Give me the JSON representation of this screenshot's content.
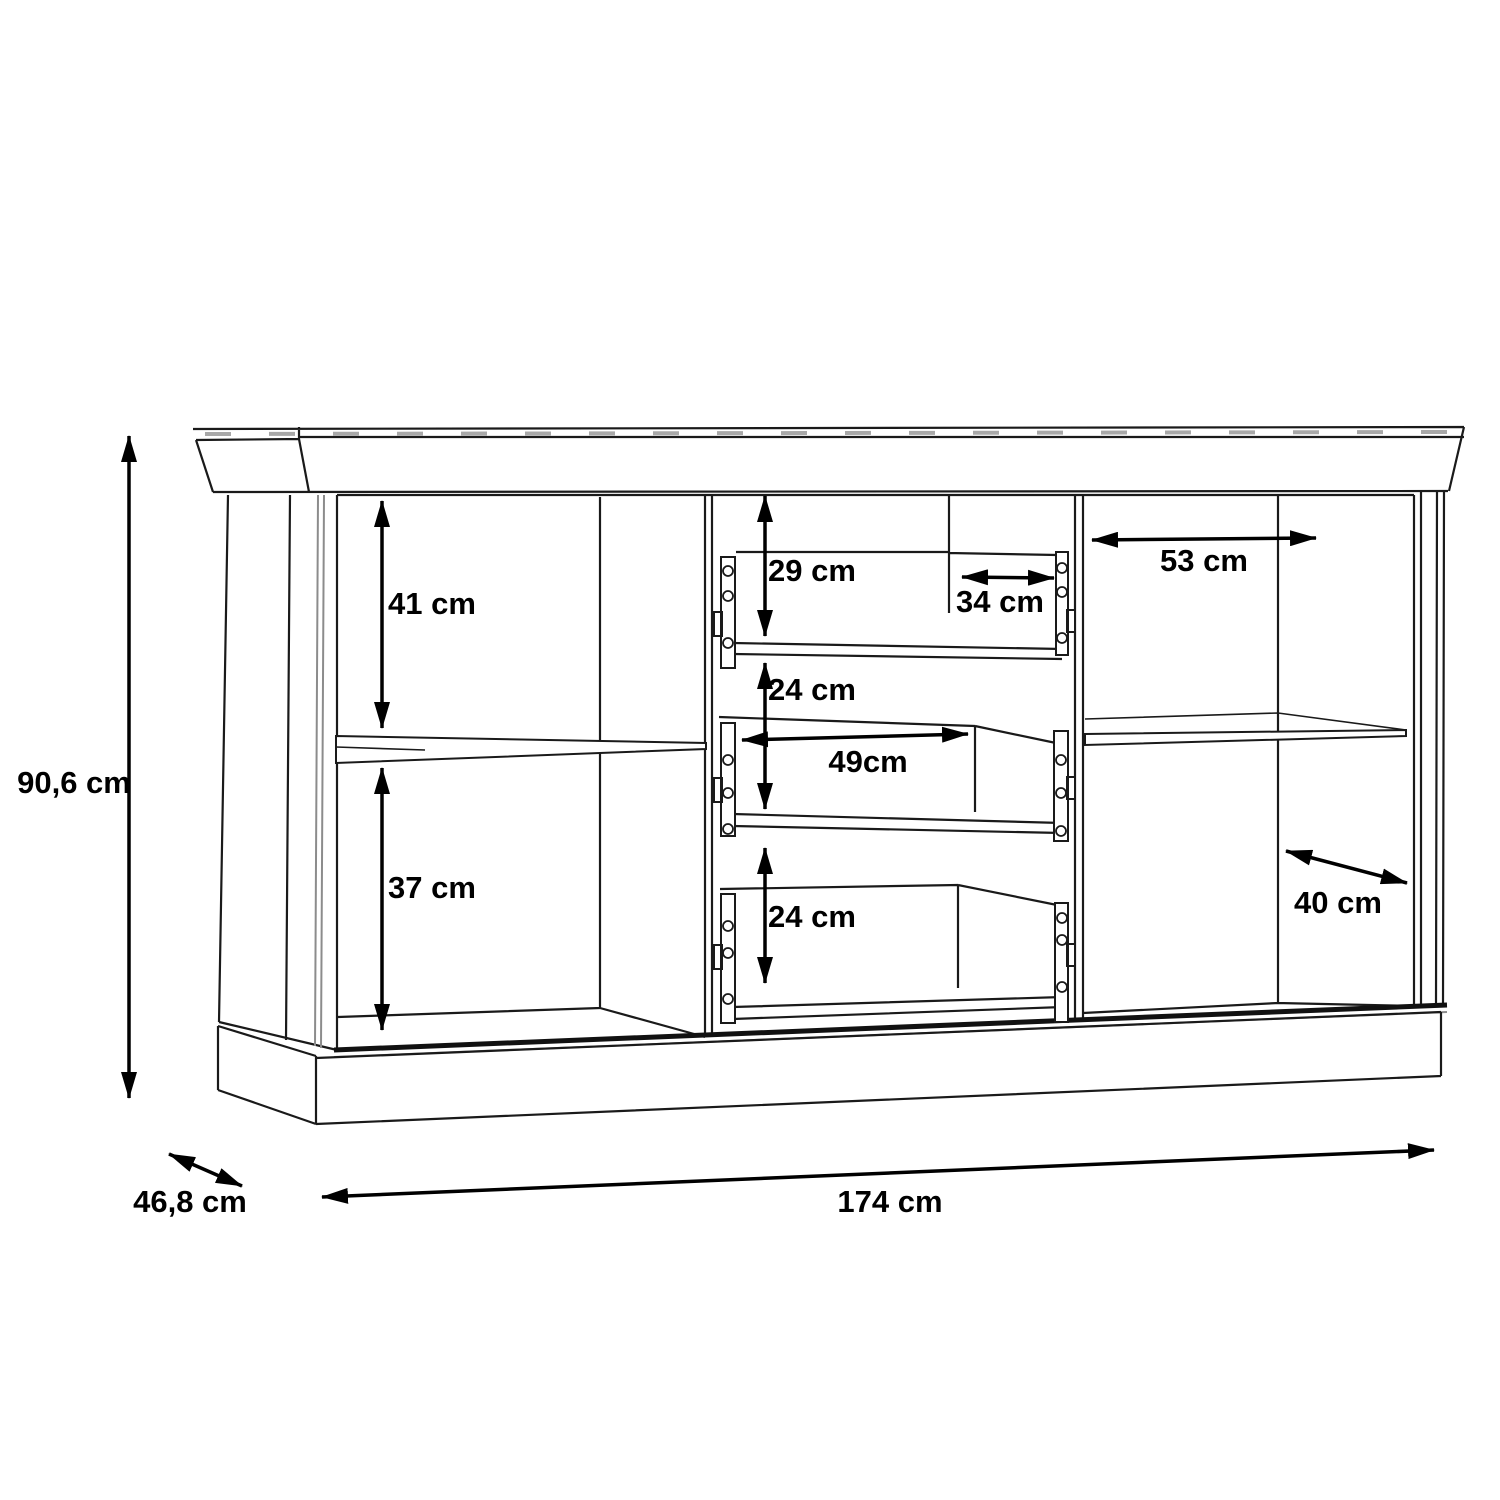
{
  "labels": {
    "height": "90,6 cm",
    "width": "174 cm",
    "depth": "46,8 cm",
    "left_upper_height": "41 cm",
    "left_lower_height": "37 cm",
    "drawer_top_height": "29 cm",
    "drawer_depth": "34 cm",
    "drawer_mid_height": "24 cm",
    "drawer_inner_width": "49cm",
    "drawer_bottom_height": "24 cm",
    "right_width": "53 cm",
    "right_depth": "40 cm"
  },
  "colors": {
    "line": "#1a1a1a",
    "dimension": "#000000",
    "gray_detail": "#8c8c8c",
    "background": "#ffffff"
  }
}
